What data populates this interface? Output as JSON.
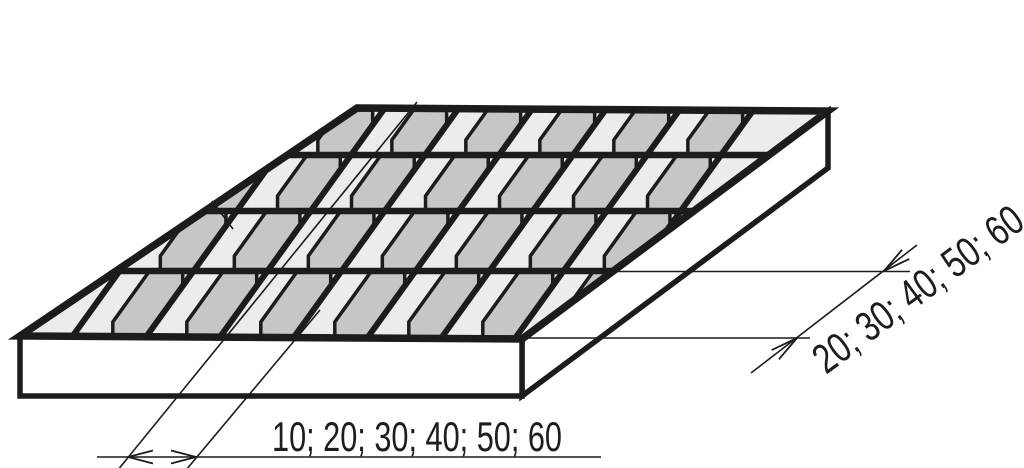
{
  "dimensions": {
    "bar_pitch_label": "10; 20; 30; 40; 50; 60",
    "cross_pitch_label": "20; 30; 40; 50; 60"
  },
  "grid": {
    "rows": 4,
    "columns": 7
  },
  "colors": {
    "line": "#1c1c1c",
    "top_face": "#ececec",
    "bar_face": "#c6c6c6",
    "solid_face": "#ffffff",
    "background": "#ffffff",
    "text": "#1d1d1d"
  }
}
